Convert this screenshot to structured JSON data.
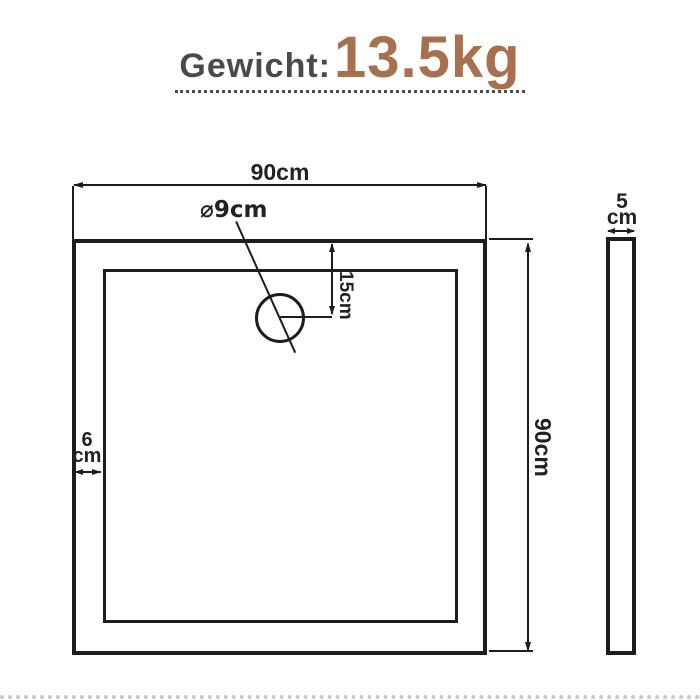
{
  "header": {
    "weight_label": "Gewicht:",
    "weight_value": "13.5kg"
  },
  "colors": {
    "label_gray": "#4a4a4a",
    "value_brown": "#a7704e",
    "line_black": "#1d1d1b"
  },
  "front_view": {
    "width_dim": "90cm",
    "height_dim": "90cm",
    "drain_diameter_dim": "⌀9cm",
    "drain_offset_dim": "15cm",
    "rim_value": "6",
    "rim_unit": "cm"
  },
  "side_view": {
    "thickness_value": "5",
    "thickness_unit": "cm"
  }
}
